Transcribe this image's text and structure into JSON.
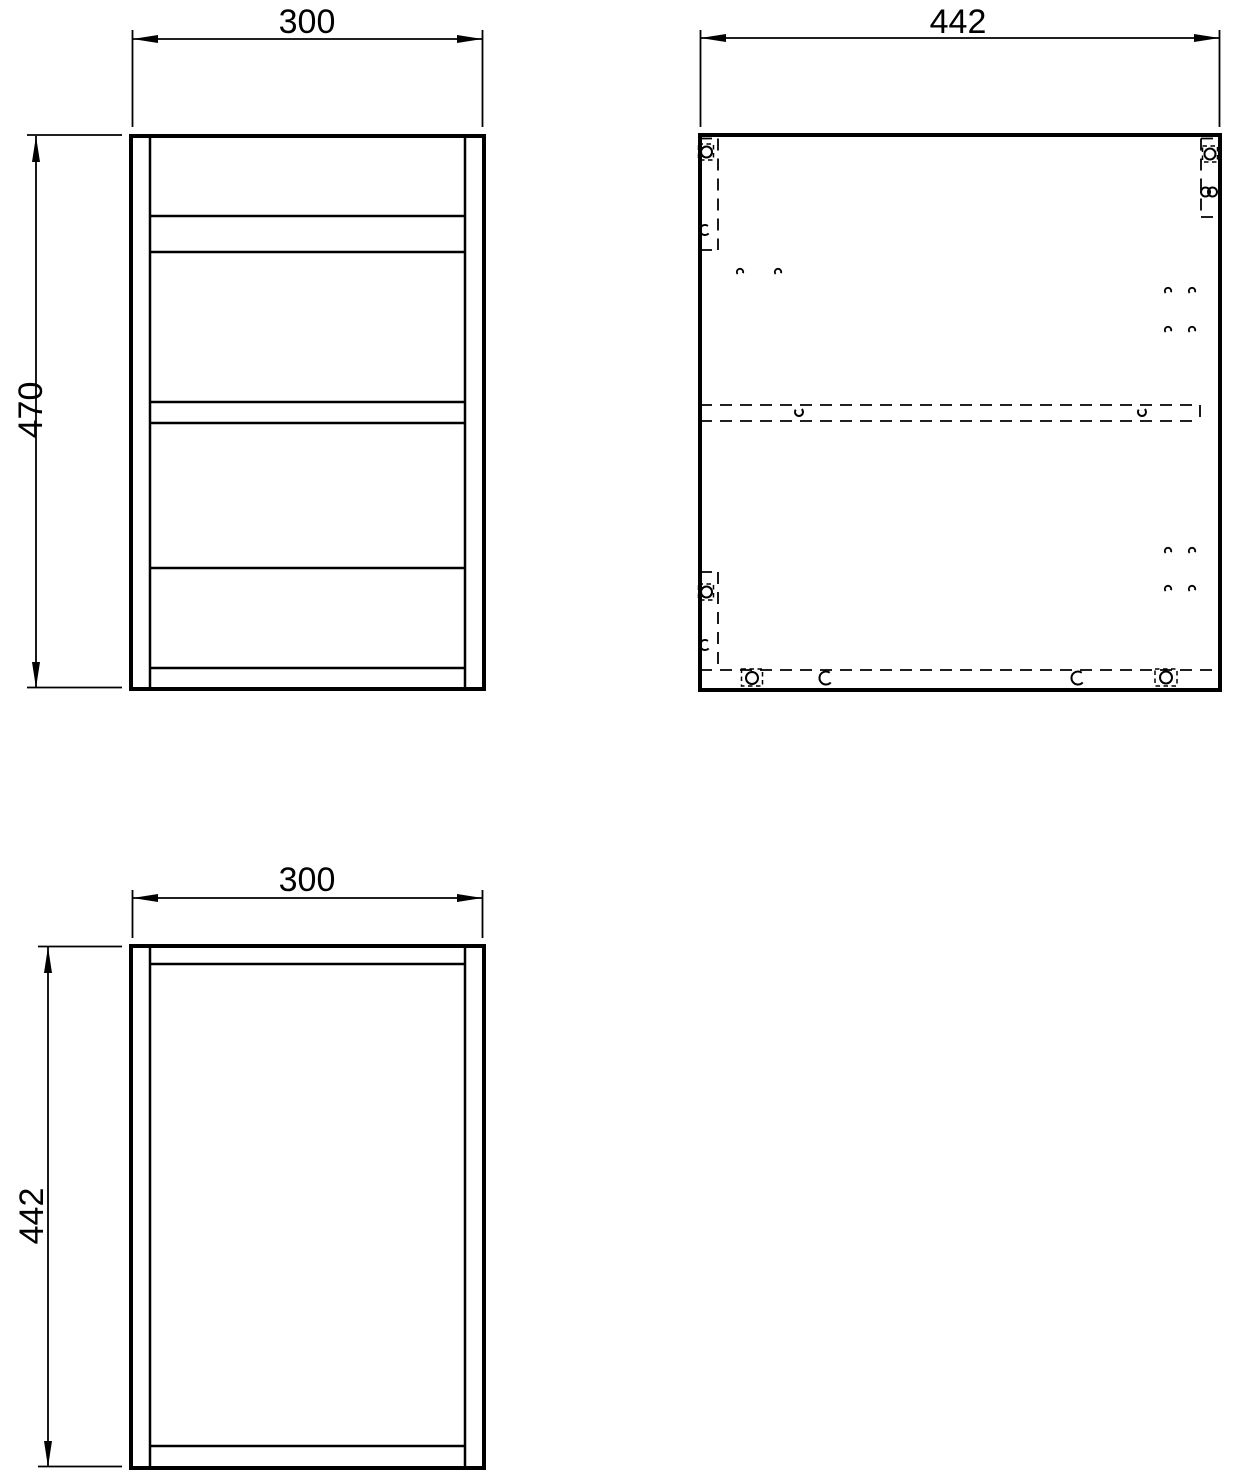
{
  "page": {
    "background": "#ffffff",
    "line_color": "#000000"
  },
  "drawing": {
    "type": "technical-orthographic-cabinet-drawing",
    "views": {
      "front": {
        "label_width": "300",
        "label_height": "470"
      },
      "side": {
        "label_width": "442"
      },
      "plan": {
        "label_width": "300",
        "label_depth": "442"
      }
    }
  }
}
